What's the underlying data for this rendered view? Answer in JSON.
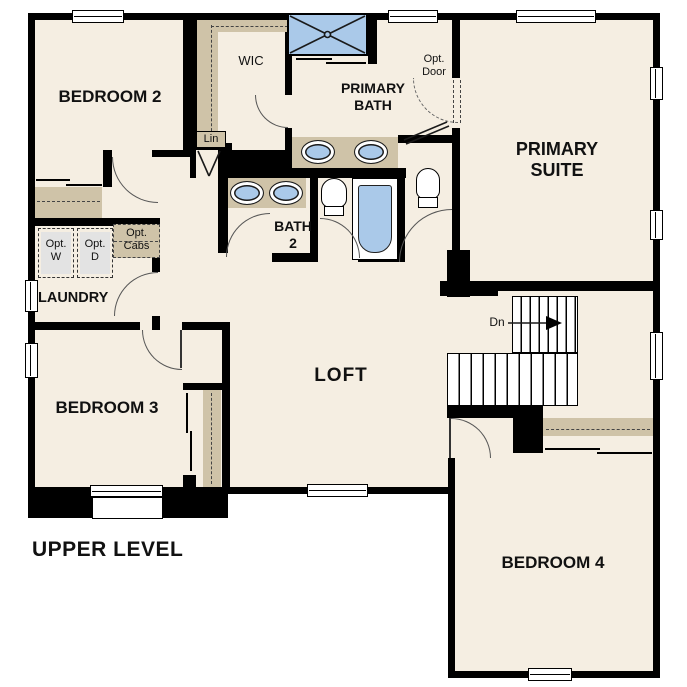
{
  "title": "UPPER LEVEL",
  "colors": {
    "floor": "#f5eee2",
    "millwork": "#cfc3a8",
    "fixture_blue": "#aac9e9",
    "appliance_gray": "#e3e3e3",
    "wall": "#000000"
  },
  "rooms": {
    "bedroom2": "BEDROOM 2",
    "wic": "WIC",
    "primary_bath": [
      "PRIMARY",
      "BATH"
    ],
    "primary_suite": [
      "PRIMARY",
      "SUITE"
    ],
    "bath2": [
      "BATH",
      "2"
    ],
    "laundry": "LAUNDRY",
    "loft": "LOFT",
    "bedroom3": "BEDROOM 3",
    "bedroom4": "BEDROOM 4"
  },
  "closets": {
    "linen": "Lin"
  },
  "options": {
    "washer": [
      "Opt.",
      "W"
    ],
    "dryer": [
      "Opt.",
      "D"
    ],
    "cabinets": [
      "Opt.",
      "Cabs"
    ],
    "door": [
      "Opt.",
      "Door"
    ]
  },
  "stairs": {
    "direction_label": "Dn"
  }
}
